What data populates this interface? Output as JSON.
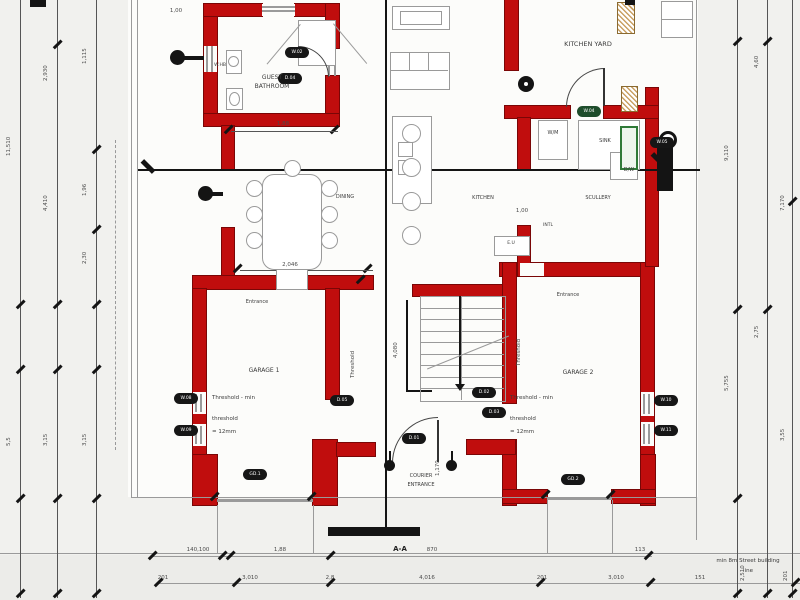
{
  "labels": {
    "kitchen_yard": "KITCHEN YARD",
    "guest_bath_l1": "GUEST",
    "guest_bath_l2": "BATHROOM",
    "whb": "W.HB",
    "dining": "DINING",
    "kitchen": "KITCHEN",
    "scullery": "SCULLERY",
    "sink": "SINK",
    "wm": "W/M",
    "dw": "D/W",
    "intl": "INTL",
    "eu": "E.U",
    "garage1": "GARAGE 1",
    "garage2": "GARAGE 2",
    "entrance": "Entrance",
    "courier_l1": "COURIER",
    "courier_l2": "ENTRANCE",
    "threshold_l1": "Threshold - min",
    "threshold_l2": "threshold",
    "threshold_l3": "= 12mm",
    "section": "A-A",
    "street_note_l1": "min 8m Street building",
    "street_note_l2": "line"
  },
  "tags": [
    {
      "x": 285,
      "y": 47,
      "t": "W.02"
    },
    {
      "x": 278,
      "y": 73,
      "t": "D.04"
    },
    {
      "x": 650,
      "y": 137,
      "t": "W.05"
    },
    {
      "x": 577,
      "y": 106,
      "t": "W.04",
      "g": 1
    },
    {
      "x": 174,
      "y": 393,
      "t": "W.08"
    },
    {
      "x": 174,
      "y": 425,
      "t": "W.09"
    },
    {
      "x": 243,
      "y": 469,
      "t": "GD.1"
    },
    {
      "x": 561,
      "y": 474,
      "t": "GD.2"
    },
    {
      "x": 654,
      "y": 395,
      "t": "W.10"
    },
    {
      "x": 654,
      "y": 425,
      "t": "W.11"
    },
    {
      "x": 402,
      "y": 433,
      "t": "D.01"
    },
    {
      "x": 472,
      "y": 387,
      "t": "D.02"
    },
    {
      "x": 482,
      "y": 407,
      "t": "D.03"
    },
    {
      "x": 330,
      "y": 395,
      "t": "D.05"
    }
  ],
  "dims_left": [
    {
      "x": 12,
      "y": 150,
      "t": "11,510"
    },
    {
      "x": 12,
      "y": 440,
      "t": "5,5"
    },
    {
      "x": 49,
      "y": 75,
      "t": "2,930"
    },
    {
      "x": 49,
      "y": 205,
      "t": "4,410"
    },
    {
      "x": 49,
      "y": 440,
      "t": "3,15"
    },
    {
      "x": 88,
      "y": 58,
      "t": "1,115"
    },
    {
      "x": 88,
      "y": 190,
      "t": "1,96"
    },
    {
      "x": 88,
      "y": 258,
      "t": "2,30"
    },
    {
      "x": 88,
      "y": 440,
      "t": "3,15"
    }
  ],
  "dims_right": [
    {
      "x": 730,
      "y": 155,
      "t": "9,110"
    },
    {
      "x": 730,
      "y": 385,
      "t": "5,755"
    },
    {
      "x": 760,
      "y": 62,
      "t": "4,60"
    },
    {
      "x": 760,
      "y": 332,
      "t": "2,75"
    },
    {
      "x": 786,
      "y": 205,
      "t": "7,170"
    },
    {
      "x": 786,
      "y": 435,
      "t": "3,55"
    }
  ],
  "dims_bottom_r1": [
    {
      "x": 198,
      "t": "140,100"
    },
    {
      "x": 280,
      "t": "1,88"
    },
    {
      "x": 432,
      "t": "870"
    },
    {
      "x": 640,
      "t": "113"
    }
  ],
  "dims_bottom_r2": [
    {
      "x": 163,
      "t": "201"
    },
    {
      "x": 250,
      "t": "3,010"
    },
    {
      "x": 330,
      "t": "2,8"
    },
    {
      "x": 427,
      "t": "4,016"
    },
    {
      "x": 542,
      "t": "201"
    },
    {
      "x": 616,
      "t": "3,010"
    },
    {
      "x": 700,
      "t": "151"
    },
    {
      "x": 746,
      "t": "2,510"
    },
    {
      "x": 789,
      "t": "201"
    }
  ],
  "dims_inline": [
    {
      "x": 283,
      "y": 121,
      "t": "1,88"
    },
    {
      "x": 290,
      "y": 262,
      "t": "2,046"
    },
    {
      "x": 522,
      "y": 208,
      "t": "1,00"
    },
    {
      "x": 176,
      "y": 8,
      "t": "1,00"
    },
    {
      "x": 399,
      "y": 352,
      "t": "4,080",
      "rot": 1
    },
    {
      "x": 441,
      "y": 470,
      "t": "1,170",
      "rot": 1
    },
    {
      "x": 356,
      "y": 372,
      "t": "Threshold",
      "rot": 1
    },
    {
      "x": 522,
      "y": 360,
      "t": "Threshold",
      "rot": 1
    }
  ],
  "colors": {
    "wall": "#c00d0d",
    "wall_edge": "#7a0606",
    "section_line": "#1a1a1a",
    "dim_line": "#555555",
    "tag_bg": "#161616",
    "tag_green": "#1e4d2b",
    "window_green": "#2f7a38",
    "hatch_tan": "#c9a063",
    "paper": "#f1f1ee",
    "plan_bg": "#fcfcfa"
  }
}
